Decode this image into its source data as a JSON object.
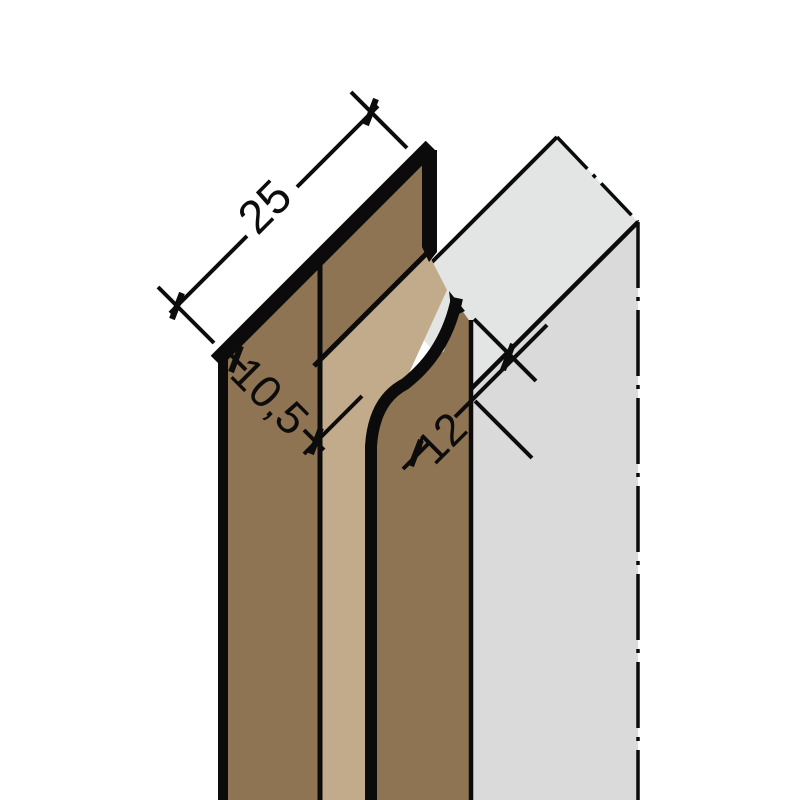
{
  "figure": {
    "kind": "isometric technical drawing of a panel joint profile",
    "background_color": "#ffffff",
    "outline_color": "#0b0b0b",
    "materials": {
      "profile_face_color": "#8e7453",
      "profile_web_color": "#c2ab8b",
      "panel_top_color": "#e3e5e4",
      "panel_front_color": "#d9dad9"
    },
    "dimensions": [
      {
        "id": "profile-width",
        "label": "25"
      },
      {
        "id": "profile-depth",
        "label": "10,5"
      },
      {
        "id": "slot-width",
        "label": "12"
      }
    ],
    "line_styles": {
      "panel_cut_edge": "dash-dot centerline",
      "dimension_ticks": "oblique"
    }
  }
}
